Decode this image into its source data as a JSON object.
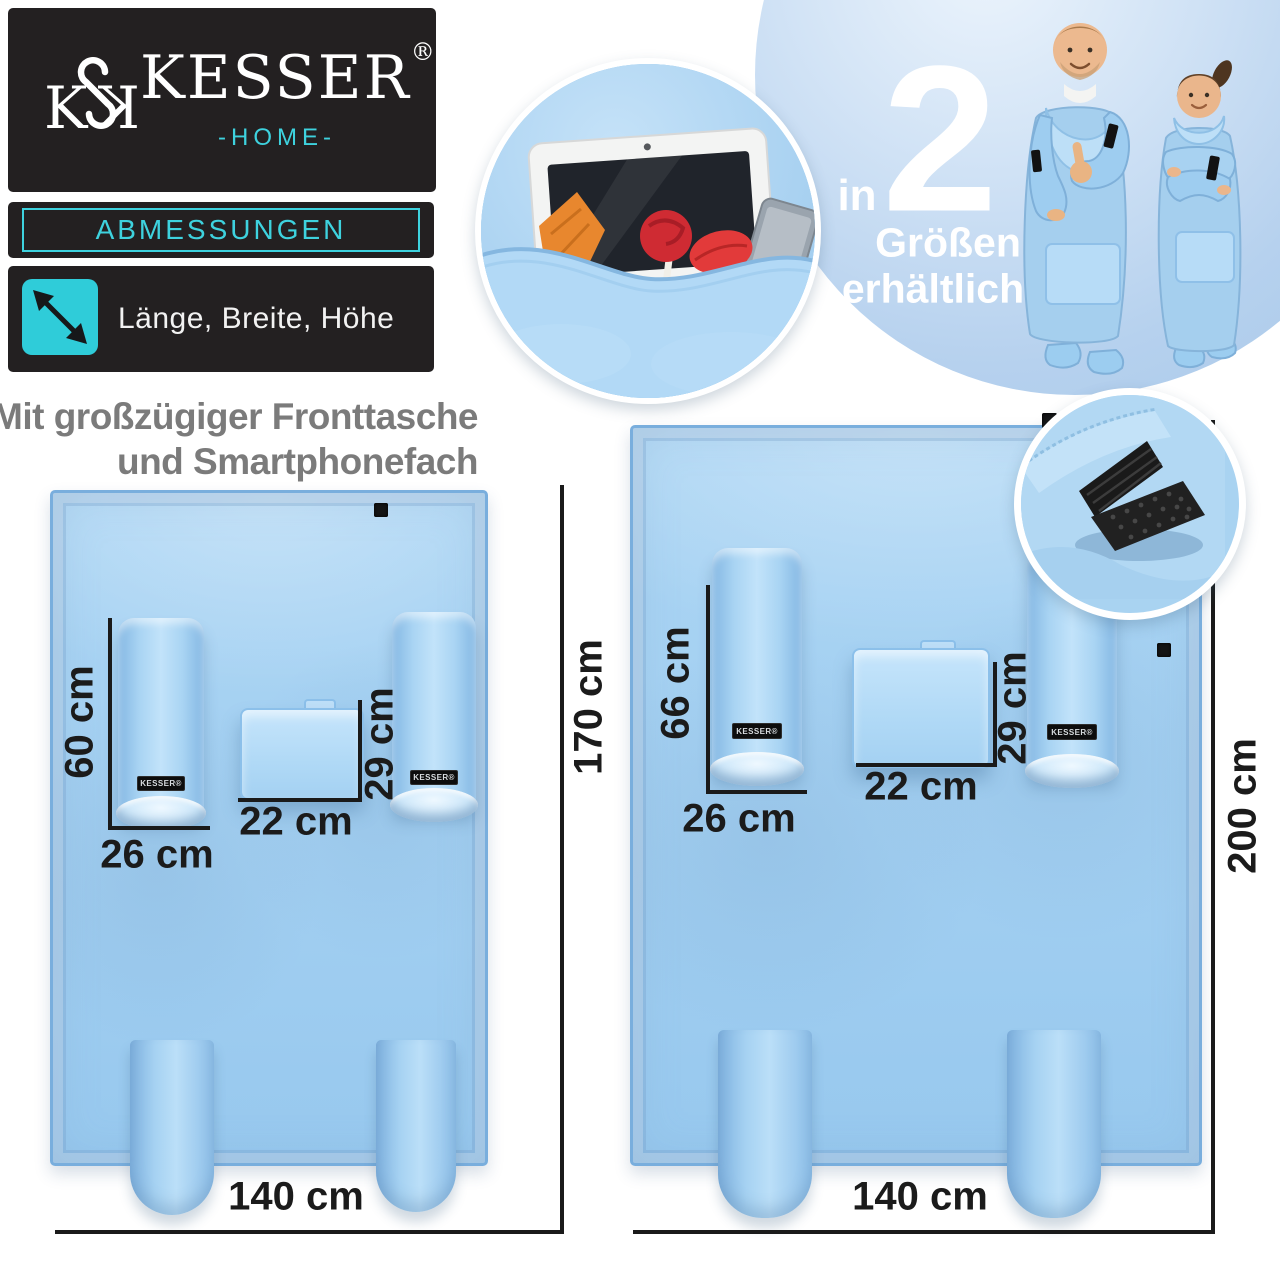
{
  "brand": {
    "name": "KESSER",
    "reg": "®",
    "home": "-HOME-",
    "monogram": "kesser-ks-monogram"
  },
  "panel": {
    "section": "ABMESSUNGEN",
    "legend": "Länge, Breite, Höhe",
    "legend_icon": "diagonal-resize-arrow-icon"
  },
  "headline": {
    "line1": "Mit großzügiger Fronttasche",
    "line2": "und Smartphonefach"
  },
  "promo": {
    "prefix": "in",
    "number": "2",
    "word1": "Größen",
    "word2": "erhältlich"
  },
  "sleeve_label": "KESSER®",
  "insets": {
    "pocket_photo": "front-pocket-with-tablet-snacks-smartphone",
    "velcro_photo": "velcro-fastener-detail",
    "models_photo": "man-and-woman-wearing-blanket"
  },
  "diagrams": [
    {
      "name": "blanket-size-1",
      "length": "170 cm",
      "width": "140 cm",
      "sleeve_length": "60 cm",
      "sleeve_width": "26 cm",
      "pocket_width": "22 cm",
      "pocket_height": "29 cm"
    },
    {
      "name": "blanket-size-2",
      "length": "200 cm",
      "width": "140 cm",
      "sleeve_length": "66 cm",
      "sleeve_width": "26 cm",
      "pocket_width": "22 cm",
      "pocket_height": "29 cm"
    }
  ],
  "colors": {
    "accent_teal": "#3ed2de",
    "panel_black": "#232021",
    "blanket_blue": "#a6d2f2",
    "dimension_text": "#1b1b1b",
    "headline_gray": "#7b7b7b",
    "circle_blue": "#b6d1ee"
  }
}
